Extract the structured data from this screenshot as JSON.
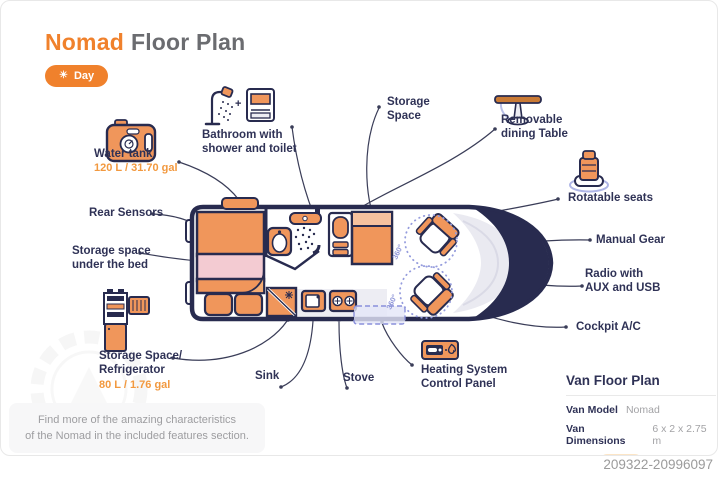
{
  "page": {
    "title_accent": "Nomad",
    "title_rest": "Floor Plan",
    "mode_button": {
      "icon": "☀",
      "label": "Day"
    },
    "image_id": "209322-20996097",
    "footer_note": {
      "line1": "Find more of the amazing characteristics",
      "line2": "of the Nomad in the included features section."
    }
  },
  "colors": {
    "accent_orange": "#F0812C",
    "furniture_orange": "#F0965B",
    "outline_navy": "#282B4F",
    "lavender": "#9298DA",
    "pink": "#F3CBD2"
  },
  "diagram": {
    "rotation_label": "360°",
    "plus_sign": "+"
  },
  "labels": {
    "water_tank": {
      "line1": "Water tank",
      "value": "120 L / 31.70 gal"
    },
    "rear_sensors": {
      "line1": "Rear Sensors"
    },
    "storage_under_bed": {
      "line1": "Storage space",
      "line2": "under the bed"
    },
    "fridge": {
      "line1": "Storage Space/",
      "line2": "Refrigerator",
      "value": "80 L / 1.76 gal"
    },
    "bathroom": {
      "line1": "Bathroom with",
      "line2": "shower and toilet"
    },
    "storage_space": {
      "line1": "Storage",
      "line2": "Space"
    },
    "dining_table": {
      "line1": "Removable",
      "line2": "dining Table"
    },
    "rotatable_seats": {
      "line1": "Rotatable seats"
    },
    "manual_gear": {
      "line1": "Manual Gear"
    },
    "radio": {
      "line1": "Radio with",
      "line2": "AUX and USB"
    },
    "cockpit_ac": {
      "line1": "Cockpit A/C"
    },
    "sink": {
      "line1": "Sink"
    },
    "stove": {
      "line1": "Stove"
    },
    "heating": {
      "line1": "Heating System",
      "line2": "Control Panel"
    }
  },
  "info_panel": {
    "title": "Van Floor Plan",
    "rows": [
      {
        "label": "Van Model",
        "value": "Nomad"
      },
      {
        "label": "Van Dimensions",
        "value": "6 x 2 x 2.75 m"
      },
      {
        "label": "Units",
        "value": "Meter"
      }
    ]
  }
}
